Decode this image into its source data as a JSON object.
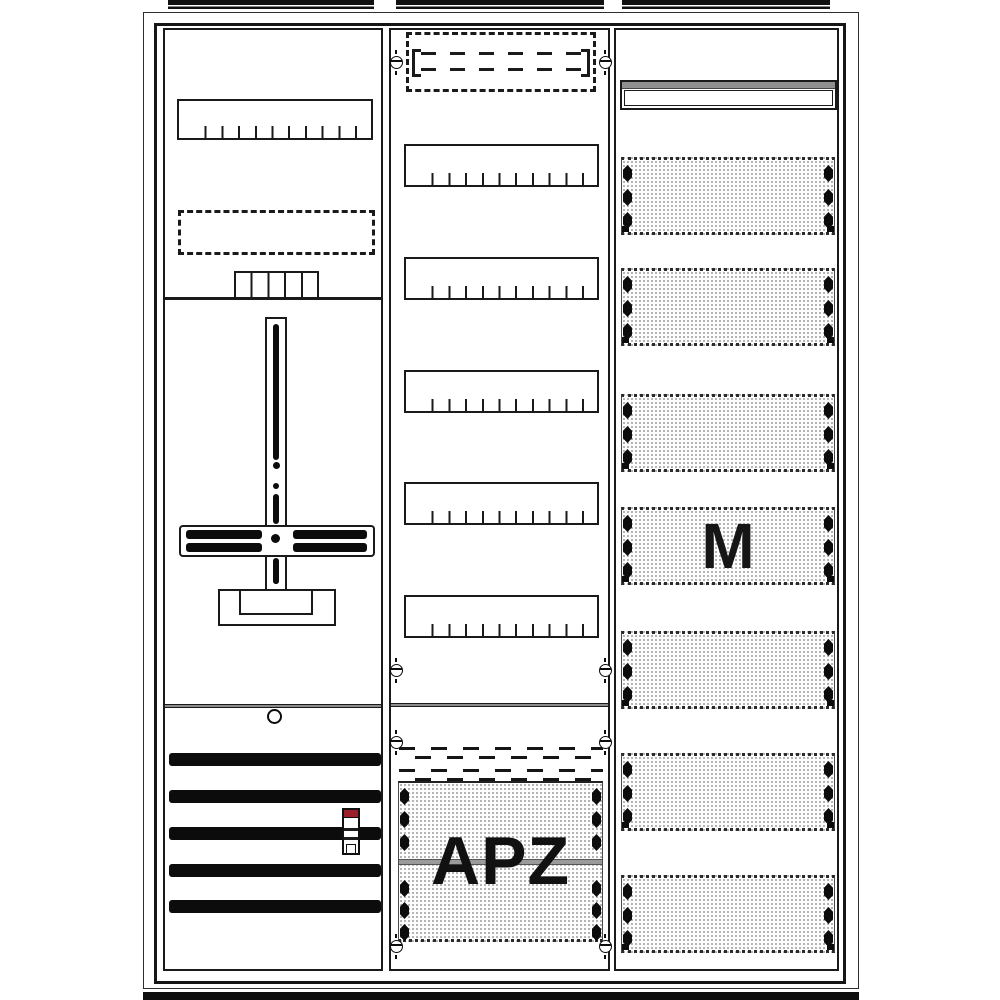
{
  "labels": {
    "apz_panel": "APZ",
    "module_panel": "M"
  },
  "colors": {
    "line": "#1a1a1a",
    "red_accent": "#9b1f2a",
    "gray_accent": "#8f8f8f",
    "dot_texture": "#9c9c9c"
  },
  "geometry": {
    "top_flanges": [
      {
        "x": 168,
        "w": 206
      },
      {
        "x": 396,
        "w": 208
      },
      {
        "x": 622,
        "w": 208
      }
    ],
    "left_column": {
      "busbar_ys": [
        723,
        760,
        797,
        834,
        870
      ],
      "busbar": {
        "x": 4,
        "w": 212,
        "h": 13
      }
    },
    "middle_column": {
      "rail_ys": [
        114,
        227,
        340,
        452,
        565
      ],
      "rail": {
        "x": 13,
        "w": 195,
        "h": 43
      },
      "screw_pair_ys": [
        32,
        640,
        712,
        916
      ],
      "screw_xs": [
        5,
        214
      ]
    },
    "right_column": {
      "panel_ys": [
        127,
        238,
        364,
        477,
        601,
        723,
        845
      ],
      "panel": {
        "x": 5,
        "w": 214,
        "h": 78
      },
      "m_panel_index": 3,
      "diamond_tops": [
        5,
        29,
        52
      ]
    },
    "apz_panel": {
      "diamond_tops": [
        5,
        28,
        51,
        97,
        119,
        141
      ]
    }
  }
}
